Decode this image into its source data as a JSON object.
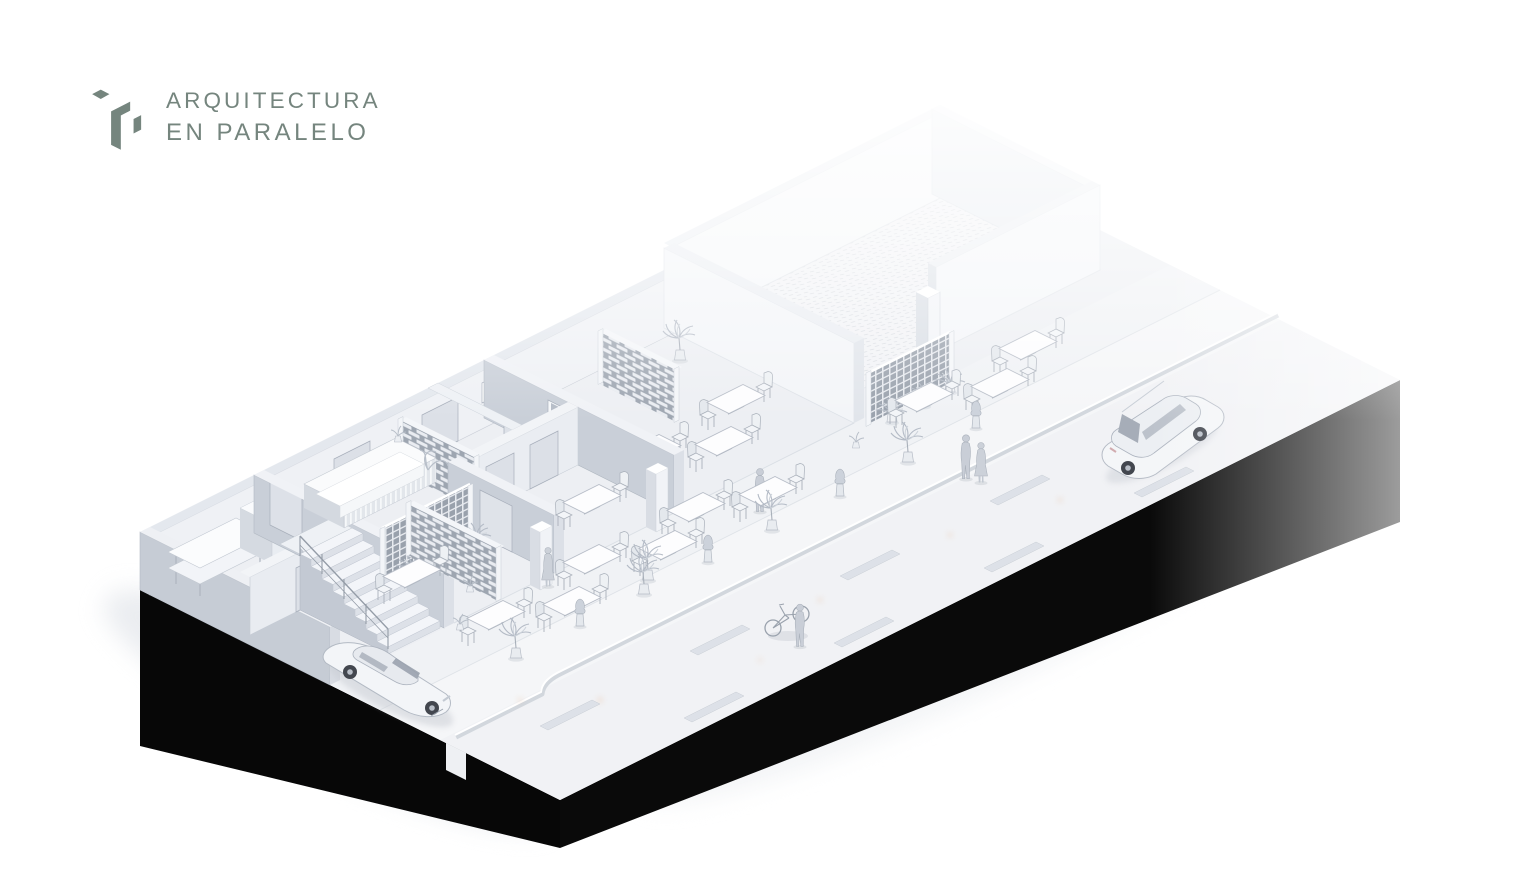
{
  "logo": {
    "mark_icon": "arquitectura-en-paralelo-logo-icon",
    "line1": "ARQUITECTURA",
    "line2": "EN PARALELO",
    "color": "#75857E"
  },
  "scene": {
    "colors": {
      "background": "#ffffff",
      "plinth": "#070707",
      "floor": "#edeff3",
      "sidewalk": "#f5f6f8",
      "street": "#f1f2f5",
      "wall_cut": "#c9cfd8",
      "wall_light": "#eff1f5",
      "screen_shadow": "#9ea6b1",
      "shadow": "#d6dade"
    }
  }
}
